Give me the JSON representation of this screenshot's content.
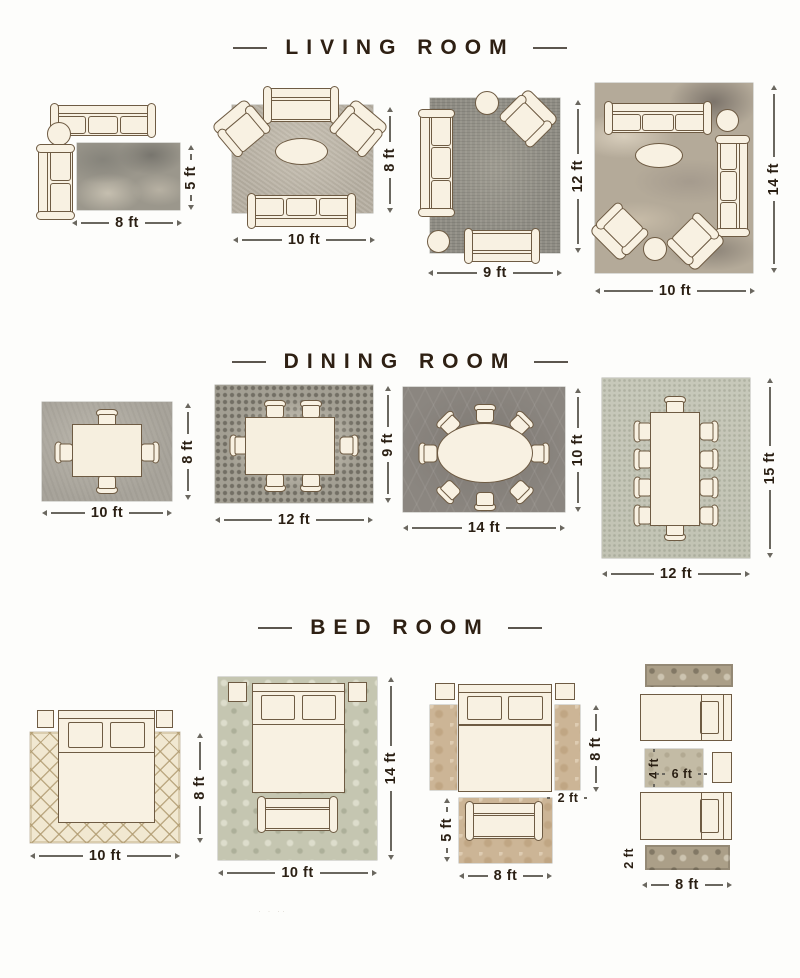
{
  "palette": {
    "ink": "#2b2014",
    "furniture_fill": "#f8f1e2",
    "furniture_outline": "#6e5b43",
    "page_bg": "#fdfdfb",
    "title_color": "#2e2013"
  },
  "watermark": "· · ··",
  "sections": [
    {
      "title": "LIVING ROOM",
      "layouts": [
        {
          "name": "living-8x5",
          "width": "8 ft",
          "height": "5 ft",
          "rug": "gray-marble-rug",
          "furniture": [
            "sofa",
            "round-side-table",
            "loveseat"
          ]
        },
        {
          "name": "living-10x8",
          "width": "10 ft",
          "height": "8 ft",
          "rug": "taupe-rug",
          "furniture": [
            "loveseat",
            "armchair",
            "armchair",
            "oval-coffee-table",
            "sofa"
          ]
        },
        {
          "name": "living-9x12",
          "width": "9 ft",
          "height": "12 ft",
          "rug": "charcoal-distressed-rug",
          "furniture": [
            "round-side-table",
            "armchair",
            "sofa",
            "round-side-table",
            "loveseat"
          ]
        },
        {
          "name": "living-10x14",
          "width": "10 ft",
          "height": "14 ft",
          "rug": "abstract-beige-rug",
          "furniture": [
            "sofa",
            "round-side-table",
            "oval-coffee-table",
            "sofa",
            "armchair",
            "armchair",
            "round-side-table"
          ]
        }
      ]
    },
    {
      "title": "DINING ROOM",
      "layouts": [
        {
          "name": "dining-10x8",
          "width": "10 ft",
          "height": "8 ft",
          "rug": "gray-rug",
          "table": "rectangular",
          "chairs": 4
        },
        {
          "name": "dining-12x9",
          "width": "12 ft",
          "height": "9 ft",
          "rug": "mosaic-rug",
          "table": "rectangular",
          "chairs": 6
        },
        {
          "name": "dining-14x10",
          "width": "14 ft",
          "height": "10 ft",
          "rug": "dark-trellis-rug",
          "table": "oval",
          "chairs": 8
        },
        {
          "name": "dining-12x15",
          "width": "12 ft",
          "height": "15 ft",
          "rug": "sage-rug",
          "table": "long-rectangular",
          "chairs": 10
        }
      ]
    },
    {
      "title": "BED ROOM",
      "layouts": [
        {
          "name": "bed-10x8",
          "width": "10 ft",
          "height": "8 ft",
          "rug": "cream-lattice-rug",
          "furniture": [
            "nightstand",
            "bed",
            "nightstand"
          ]
        },
        {
          "name": "bed-10x14",
          "width": "10 ft",
          "height": "14 ft",
          "rug": "sage-damask-rug",
          "furniture": [
            "nightstand",
            "bed",
            "nightstand",
            "bench"
          ]
        },
        {
          "name": "bed-8x5-with-runners",
          "width": "8 ft",
          "height": "8 ft",
          "runner_width": "2 ft",
          "foot_rug_height": "5 ft",
          "rug": "tan-floral-rug",
          "furniture": [
            "nightstand",
            "bed",
            "nightstand",
            "bench"
          ]
        },
        {
          "name": "twin-beds-runners",
          "width": "8 ft",
          "runner_height": "2 ft",
          "middle_rug_width": "6 ft",
          "middle_rug_height": "4 ft",
          "rug": "ornate-runner-rug",
          "furniture": [
            "twin-bed",
            "nightstand",
            "twin-bed"
          ]
        }
      ]
    }
  ]
}
